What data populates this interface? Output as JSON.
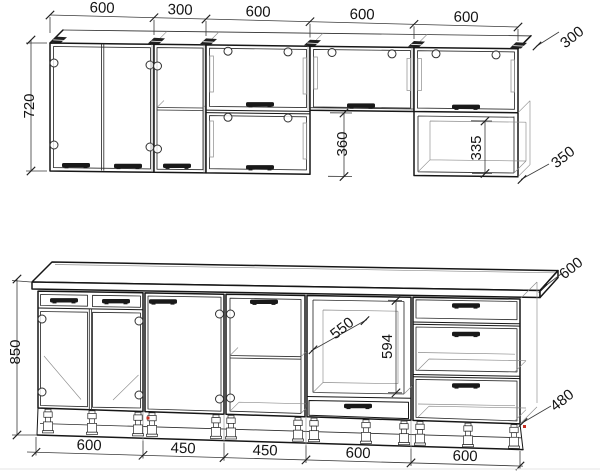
{
  "drawing": {
    "type": "kitchen-cabinet-blueprint",
    "units_shown": "mm",
    "colors": {
      "background": "#ffffff",
      "line": "#161616",
      "line_light": "#8c8c8c",
      "marker_red": "#c62f22"
    },
    "upper_row": {
      "width_dims": [
        "600",
        "300",
        "600",
        "600",
        "600"
      ],
      "height_dim": "720",
      "flip_door_height_dim": "360",
      "open_shelf_inner_height_dim": "335",
      "cabinet_depth_dim": "300",
      "open_shelf_depth_dim": "350"
    },
    "lower_row": {
      "width_dims": [
        "600",
        "450",
        "450",
        "600",
        "600"
      ],
      "height_dim": "850",
      "oven_niche_width_dim": "550",
      "oven_niche_height_dim": "594",
      "countertop_depth_dim": "600",
      "carcass_depth_dim": "480"
    }
  }
}
